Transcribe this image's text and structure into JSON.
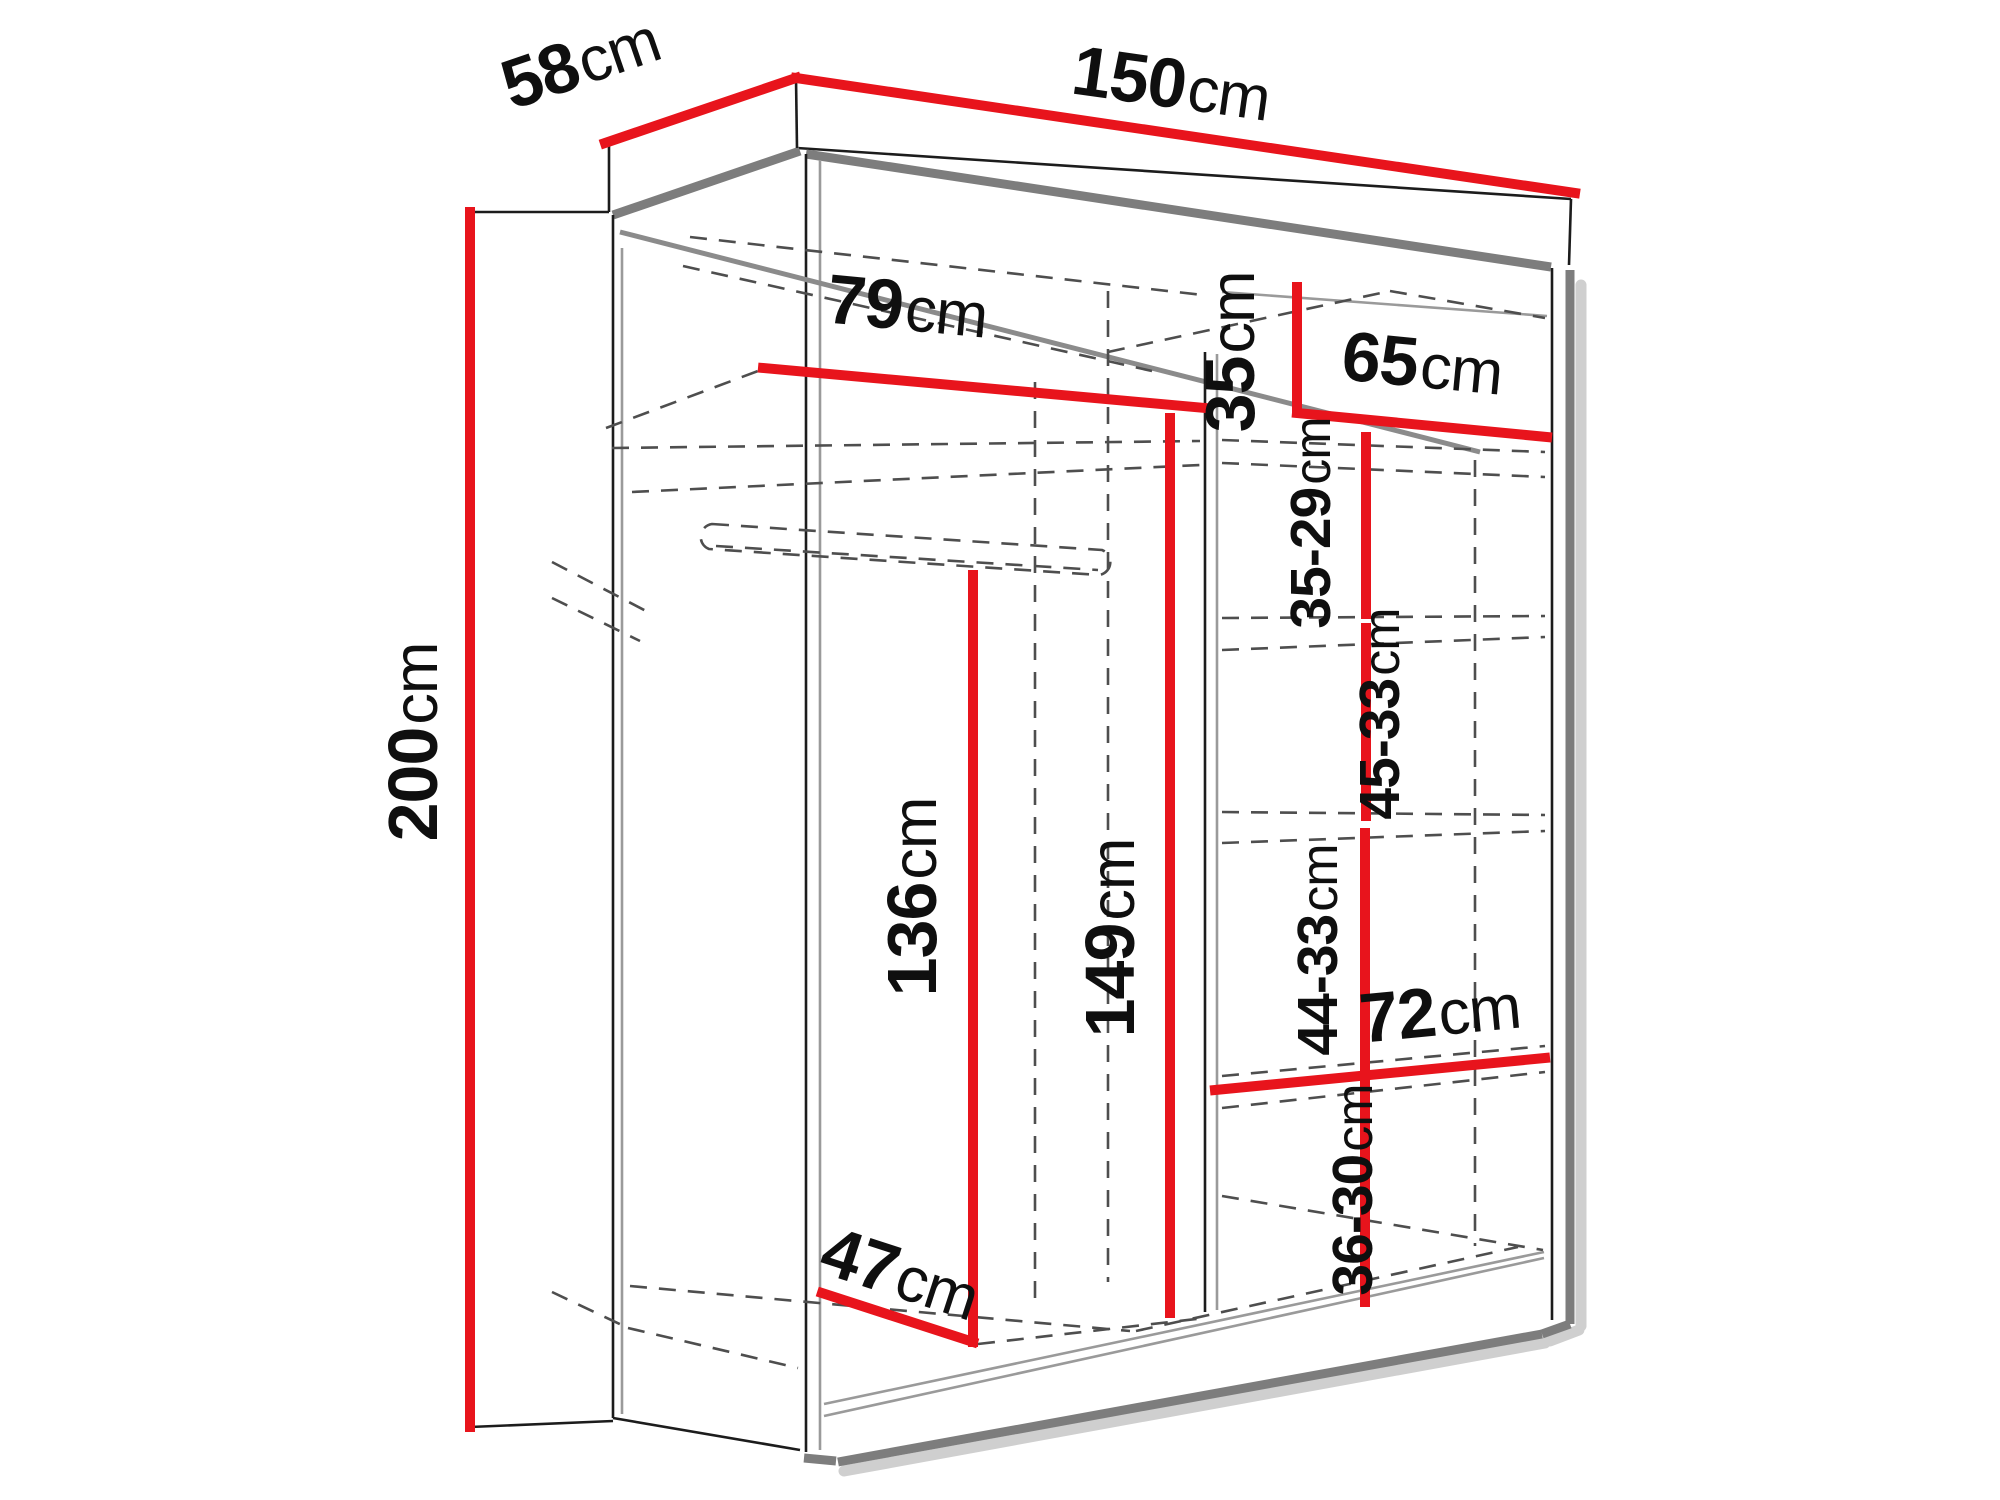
{
  "diagram": {
    "kind": "wardrobe-dimension-diagram",
    "accent_color": "#e8141c",
    "dimensions": [
      {
        "id": "depth-top",
        "num": "58",
        "unit": "cm"
      },
      {
        "id": "width-top",
        "num": "150",
        "unit": "cm"
      },
      {
        "id": "height-left",
        "num": "200",
        "unit": "cm"
      },
      {
        "id": "left-compartment-width",
        "num": "79",
        "unit": "cm"
      },
      {
        "id": "top-right-shelf-height",
        "num": "35",
        "unit": "cm"
      },
      {
        "id": "right-compartment-width",
        "num": "65",
        "unit": "cm"
      },
      {
        "id": "shelf-gap-1",
        "num": "35-29",
        "unit": "cm"
      },
      {
        "id": "shelf-gap-2",
        "num": "45-33",
        "unit": "cm"
      },
      {
        "id": "shelf-gap-3",
        "num": "44-33",
        "unit": "cm"
      },
      {
        "id": "shelf-gap-4",
        "num": "36-30",
        "unit": "cm"
      },
      {
        "id": "hanging-space-height",
        "num": "136",
        "unit": "cm"
      },
      {
        "id": "interior-height",
        "num": "149",
        "unit": "cm"
      },
      {
        "id": "bottom-shelf-width",
        "num": "72",
        "unit": "cm"
      },
      {
        "id": "bottom-left-depth",
        "num": "47",
        "unit": "cm"
      }
    ]
  }
}
